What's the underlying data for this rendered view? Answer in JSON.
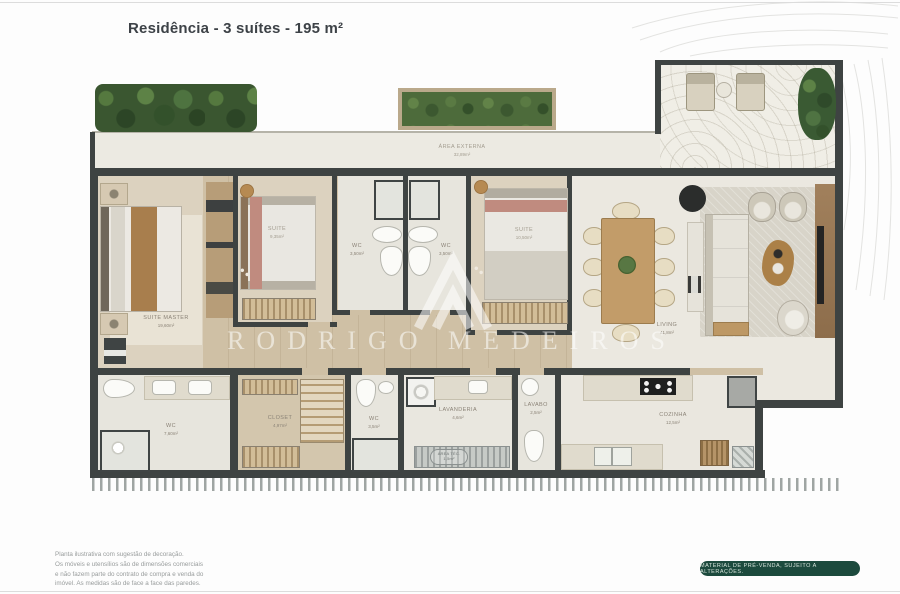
{
  "page": {
    "title": "Residência - 3 suítes - 195 m²",
    "watermark": "RODRIGO MEDEIROS",
    "badge": "MATERIAL DE PRÉ-VENDA, SUJEITO A ALTERAÇÕES.",
    "disclaimer": [
      "Planta ilustrativa com sugestão de decoração.",
      "Os móveis e utensílios são de dimensões comerciais",
      "e não fazem parte do contrato de compra e venda do",
      "imóvel. As medidas são de face a face das paredes."
    ]
  },
  "colors": {
    "wall": "#3e4342",
    "wood_floor": "#cfc0a5",
    "badge_green": "#1c4a3d",
    "hedge_green": "#3a5630",
    "title_text": "#3d4247"
  },
  "rooms": {
    "area_externa": {
      "name": "ÁREA EXTERNA",
      "area": "32,89m²"
    },
    "suite_master": {
      "name": "SUITE MASTER",
      "area": "19,60m²"
    },
    "suite_2": {
      "name": "SUITE",
      "area": "9,35m²"
    },
    "wc_suite_2": {
      "name": "WC",
      "area": "3,50m²"
    },
    "wc_suite_3": {
      "name": "WC",
      "area": "3,50m²"
    },
    "suite_3": {
      "name": "SUITE",
      "area": "10,50m²"
    },
    "living": {
      "name": "LIVING",
      "area": "41,8m²"
    },
    "wc_master": {
      "name": "WC",
      "area": "7,60m²"
    },
    "closet": {
      "name": "CLOSET",
      "area": "4,97m²"
    },
    "wc_servico": {
      "name": "WC",
      "area": "3,5m²"
    },
    "lavanderia": {
      "name": "LAVANDERIA",
      "area": "4,6m²"
    },
    "lavabo": {
      "name": "LAVABO",
      "area": "2,5m²"
    },
    "cozinha": {
      "name": "COZINHA",
      "area": "12,5m²"
    },
    "area_tecnica": {
      "name": "ÁREA TÉC.",
      "area": "1,5m²"
    }
  }
}
